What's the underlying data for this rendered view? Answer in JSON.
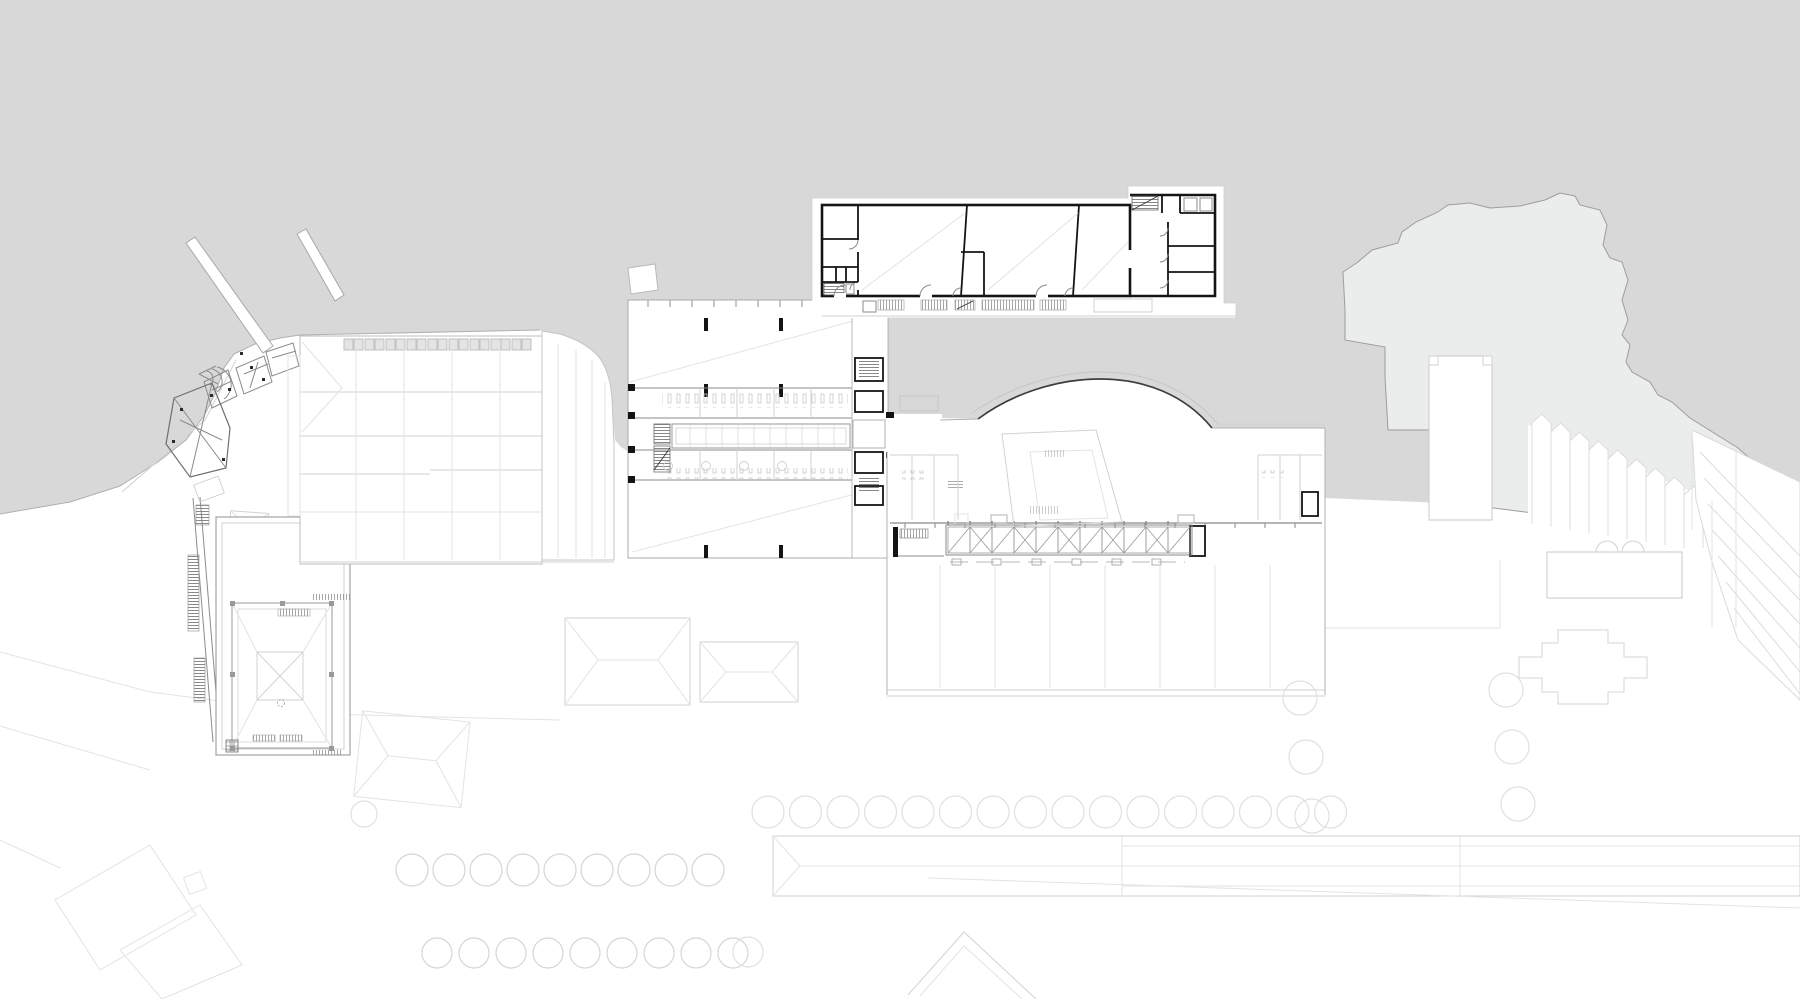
{
  "meta": {
    "type": "architectural-site-plan",
    "view": "ground-floor-roof-plan",
    "visible_text": "none"
  },
  "colors": {
    "bg": "#d8d8d8",
    "ground": "#ffffff",
    "terrain": "#ebecec",
    "terrainStroke": "#9d9d9d",
    "lineFaint": "#e3e3e3",
    "lineLight": "#d2d2d2",
    "lineMed": "#b0b0b0",
    "lineDark": "#8b8b8b",
    "lineXDark": "#6e6e6e",
    "black": "#141414",
    "hatch": "#8f8f8f",
    "skylightFill": "#e4e4e4",
    "skylightStroke": "#b4b4b4",
    "curveStroke": "#3c3c3c",
    "treeLight": "#e0e0e0",
    "treeMed": "#d5d5d5"
  },
  "site": {
    "tree_rows": [
      {
        "name": "north-promenade-row",
        "y": 812,
        "start": 768,
        "step": 37.5,
        "count": 16,
        "r": 16,
        "color": "#e0e0e0"
      },
      {
        "name": "west-alley-row-upper",
        "y": 870,
        "start": 412,
        "step": 37,
        "count": 9,
        "r": 16,
        "color": "#d5d5d5"
      },
      {
        "name": "west-alley-row-lower",
        "y": 953,
        "start": 437,
        "step": 37,
        "count": 9,
        "r": 15,
        "color": "#d5d5d5"
      }
    ],
    "tree_points": [
      {
        "x": 1300,
        "y": 698,
        "r": 17
      },
      {
        "x": 1306,
        "y": 757,
        "r": 17
      },
      {
        "x": 1312,
        "y": 816,
        "r": 17
      },
      {
        "x": 1506,
        "y": 690,
        "r": 17
      },
      {
        "x": 1512,
        "y": 747,
        "r": 17
      },
      {
        "x": 1518,
        "y": 804,
        "r": 17
      },
      {
        "x": 748,
        "y": 952,
        "r": 15
      },
      {
        "x": 364,
        "y": 814,
        "r": 13
      }
    ],
    "skylight_row": {
      "y": 339,
      "h": 11,
      "start": 344,
      "step": 21,
      "count": 9,
      "cellw": 9,
      "cells": 2
    },
    "truss_band": {
      "x": 948,
      "y": 527,
      "count": 11,
      "cellw": 22,
      "cellh": 26
    },
    "window_bands": [
      {
        "x": 878,
        "w": 26
      },
      {
        "x": 921,
        "w": 26
      },
      {
        "x": 955,
        "w": 20,
        "slash": true
      },
      {
        "x": 982,
        "w": 52
      },
      {
        "x": 1040,
        "w": 26
      }
    ],
    "sawtooth_roof": {
      "start": 1532,
      "step": 19,
      "count": 9,
      "top0": 414,
      "topStep": 9,
      "base0": 524,
      "baseStep": 3
    }
  }
}
